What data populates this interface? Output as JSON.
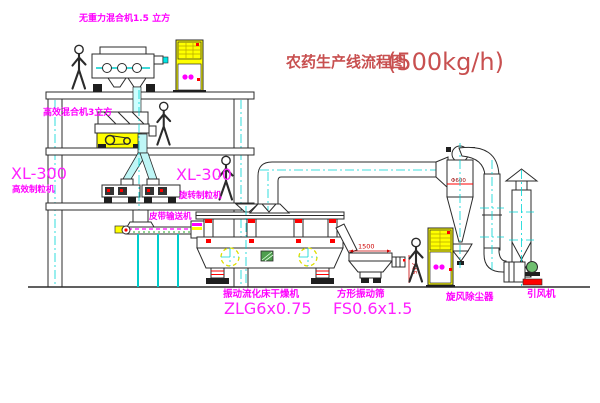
{
  "title": {
    "name_zh": "农药生产线流程图",
    "capacity": "(500kg/h)"
  },
  "labels": {
    "mixer_top": "无重力混合机1.5 立方",
    "mixer_mid": "高效混合机3立方",
    "granulator_left_model": "XL-300",
    "granulator_left_name": "高效制粒机",
    "granulator_mid_model": "XL-300",
    "granulator_mid_name": "旋转制粒机",
    "conveyor": "皮带输送机",
    "dryer_name": "振动流化床干燥机",
    "dryer_model": "ZLG6x0.75",
    "screen_name": "方形振动筛",
    "screen_model": "FS0.6x1.5",
    "cyclone_name": "旋风除尘器",
    "fan_name": "引风机"
  },
  "dimensions": {
    "screen_length": "1500",
    "screen_height": "745",
    "cyclone_diameter": "Φ600"
  },
  "colors": {
    "label_magenta": "#ff00ff",
    "title_red": "#c85050",
    "centerline_cyan": "#00d5d5",
    "machine_line": "#2b2b2b",
    "cabinet_yellow": "#ffff00",
    "accent_red": "#ff0000"
  }
}
